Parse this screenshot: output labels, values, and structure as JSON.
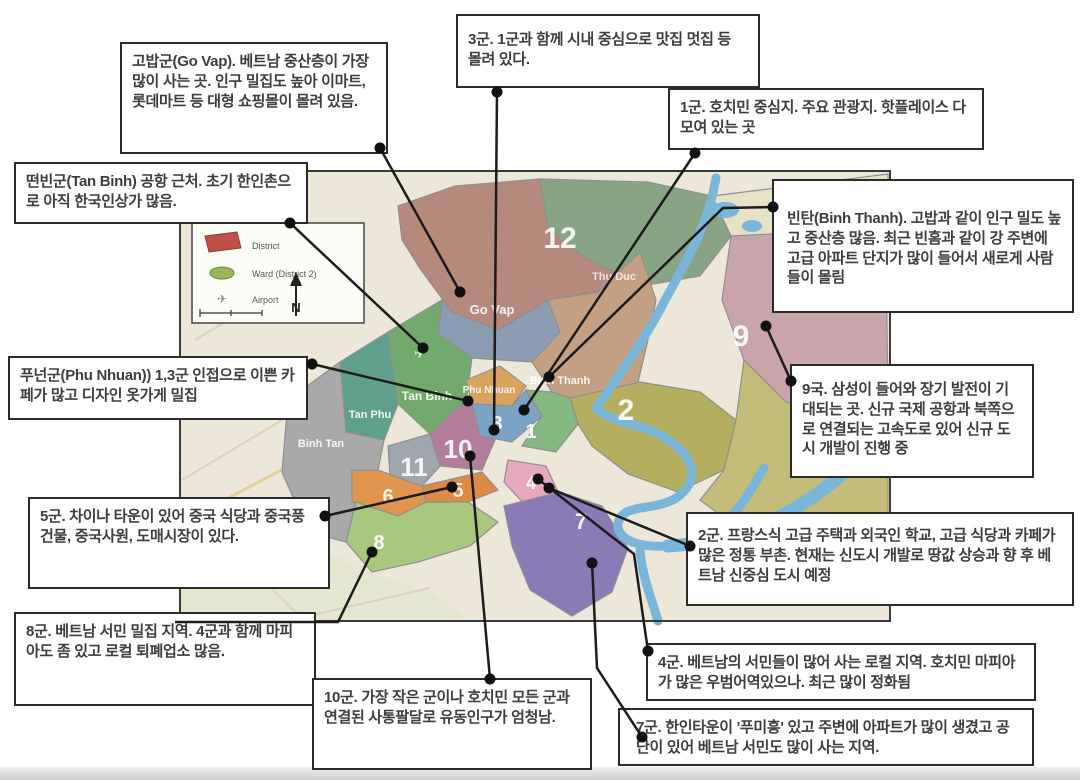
{
  "callouts": {
    "go_vap": {
      "text": "고밥군(Go Vap). 베트남 중산층이 가장 많이 사는 곳. 인구 밀집도 높아 이마트, 롯데마트 등 대형 쇼핑몰이 몰려 있음."
    },
    "tan_binh": {
      "text": "떤빈군(Tan Binh) 공항 근처. 초기 한인촌으로 아직 한국인상가 많음."
    },
    "d3": {
      "text": "3군. 1군과 함께 시내 중심으로 맛집 멋집 등 몰려 있다."
    },
    "d1": {
      "text": "1군. 호치민 중심지. 주요 관광지. 핫플레이스 다 모여 있는 곳"
    },
    "binh_thanh": {
      "text": "빈탄(Binh Thanh). 고밥과 같이 인구 밀도 높고 중산층 많음. 최근 빈홈과 같이 강 주변에 고급 아파트 단지가 많이 들어서 새로게 사람들이 몰림"
    },
    "d9": {
      "text": "9국. 삼성이 들어와 장기 발전이 기대되는 곳. 신규 국제 공항과 북쪽으로 연결되는 고속도로 있어 신규 도시 개발이 진행 중"
    },
    "phu_nhuan": {
      "text": "푸넌군(Phu Nhuan)) 1,3군 인접으로 이쁜 카페가 많고 디자인 옷가게 밀집"
    },
    "d5": {
      "text": "5군. 차이나 타운이 있어 중국 식당과 중국풍 건물, 중국사원, 도매시장이 있다."
    },
    "d8": {
      "text": "8군. 베트남 서민 밀집 지역. 4군과 함께 마피아도 좀 있고 로컬 퇴폐업소 많음."
    },
    "d2": {
      "text": "2군. 프랑스식 고급 주택과 외국인 학교, 고급 식당과 카페가 많은 정통 부촌. 현재는 신도시 개발로 땅값 상승과 향 후 베트남 신중심 도시 예정"
    },
    "d4": {
      "text": "4군. 베트남의 서민들이 많어 사는 로컬 지역. 호치민 마피아가 많은 우범어역있으나. 최근 많이 정화됨"
    },
    "d7": {
      "text": "7군. 한인타운이 '푸미흥' 있고 주변에 아파트가 많이 생겼고 공단이 있어 베트남 서민도 많이 사는 지역."
    },
    "d10": {
      "text": "10군. 가장 작은 군이나 호치민 모든 군과 연결된 사통팔달로 유동인구가 엄청남."
    }
  },
  "map": {
    "legend": {
      "district_label": "District",
      "ward_label": "Ward (District 2)",
      "airport_label": "Airport",
      "compass_n": "N"
    },
    "labels": {
      "d12": "12",
      "go_vap": "Go Vap",
      "binh_thanh": "Binh Thanh",
      "thu_duc": "Thu Duc",
      "tan_binh": "Tan Binh",
      "tan_phu": "Tan Phu",
      "phu_nhuan": "Phu Nhuan",
      "binh_tan": "Binh Tan",
      "d1": "1",
      "d2": "2",
      "d3": "3",
      "d4": "4",
      "d5": "5",
      "d6": "6",
      "d7": "7",
      "d8": "8",
      "d9": "9",
      "d10": "10",
      "d11": "11",
      "airport_icon": "✈"
    },
    "colors": {
      "background": "#ece7d8",
      "southwest": "#e4e6cf",
      "northeast": "#e7e2c6",
      "d12": "#b5897b",
      "go_vap": "#8c9cb3",
      "binh_thanh": "#c3a083",
      "thu_duc": "#87a585",
      "tan_binh": "#72a96d",
      "tan_phu": "#5fa08c",
      "phu_nhuan": "#d8a35f",
      "binh_tan": "#a9a9a9",
      "d1": "#83b880",
      "d2": "#b5ad60",
      "d2_east": "#c4bd7a",
      "d3": "#7ba3c4",
      "d4": "#e8a8bf",
      "d5": "#dd8a45",
      "d6": "#e0954f",
      "d7": "#8a7ab5",
      "d8": "#a8c87e",
      "d9": "#c9a5ab",
      "d10": "#b27c9a",
      "d11": "#9fa6ad",
      "river": "#79b6da",
      "connector": "#1c1c1c"
    }
  }
}
